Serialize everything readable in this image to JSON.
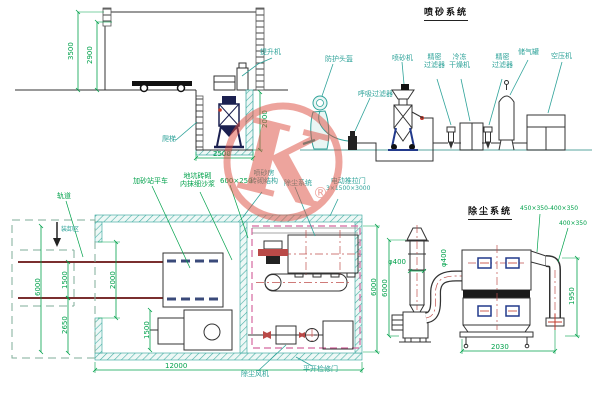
{
  "watermark": {
    "letter": "K",
    "registered": "®"
  },
  "titles": {
    "blast_system": "喷砂系统",
    "dust_system": "除尘系统"
  },
  "flow": {
    "labels": [
      {
        "t1": "防护头盔"
      },
      {
        "t1": "呼吸过滤器"
      },
      {
        "t1": "喷砂机"
      },
      {
        "t1": "精密",
        "t2": "过滤器"
      },
      {
        "t1": "冷冻",
        "t2": "干燥机"
      },
      {
        "t1": "精密",
        "t2": "过滤器"
      },
      {
        "t1": "储气罐"
      },
      {
        "t1": "空压机"
      }
    ]
  },
  "elevation": {
    "dim_total_height": "3500",
    "dim_inner_height": "2900",
    "dim_pit_depth": "2000",
    "dim_pit_width": "2500",
    "label_hoist": "提升机",
    "label_ladder": "爬梯"
  },
  "plan": {
    "label_track": "轨道",
    "label_loading": "装卸区",
    "label_sand_car": "加砂站平车",
    "label_pit_1": "地坑砖砌",
    "label_pit_2": "内抹细沙浆",
    "label_duct_size": "600×250",
    "label_room_1": "喷砂房",
    "label_room_2": "砖砌结构",
    "label_dust": "除尘系统",
    "label_door_1": "电动推拉门",
    "label_door_2": "3×1500×3000",
    "label_fan": "除尘风机",
    "label_access": "平开检修门",
    "dim_width": "6000",
    "dim_rail_gauge": "1500",
    "dim_south": "2650",
    "dim_door": "2000",
    "dim_bay": "1500",
    "dim_length": "12000",
    "dim_dust_width": "6000"
  },
  "dust": {
    "dim_stack": "φ400",
    "dim_duct": "φ400",
    "dim_height": "6000",
    "dim_transition": "450×350-400×350",
    "dim_outlet": "400×350",
    "dim_drop": "1950",
    "dim_span": "2030"
  },
  "colors": {
    "label_teal": "#2fa39a",
    "dim_green": "#00a14b",
    "rail_red": "#7a2f2f",
    "centerline_red": "#c0504d",
    "boundary_magenta": "#d4679f",
    "hatch_teal": "#49b0a6",
    "watermark_red": "#dd4b3e",
    "equipment_navy": "#1b2050"
  }
}
